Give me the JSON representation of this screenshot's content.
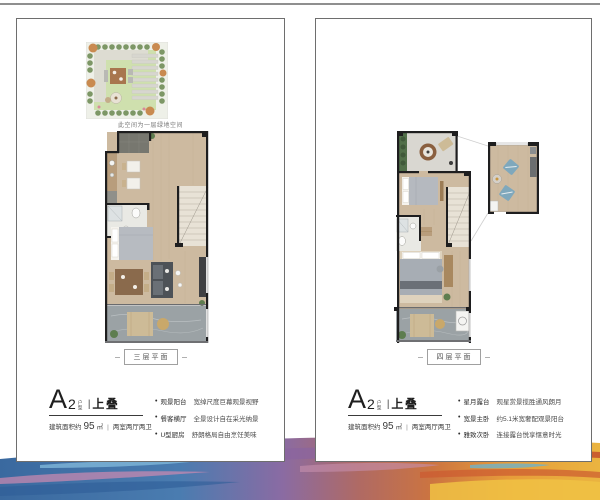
{
  "page": {
    "top_rule_color": "#8f8f8f",
    "background": "#ffffff"
  },
  "palette": {
    "wall": "#1e1e1f",
    "wood_floor": "#cdbaa0",
    "stone_floor": "#9ba2a5",
    "entry_tile": "#77776f",
    "accent_chair_blue": "#7fa8bc",
    "garden_lawn": "#cfe0ae",
    "paint_left_blue": "#3a699f",
    "paint_right_orange": "#e79d3a",
    "label_border": "#a0a0a0",
    "text_dark": "#1f1f1f",
    "text_gray": "#555555"
  },
  "panels": [
    {
      "garden_caption": "此空间为一层绿地空间",
      "floor_label": "三层平面",
      "unit": {
        "letter": "A",
        "number": "2",
        "small": "户型",
        "sep": "|",
        "name": "上叠"
      },
      "area": {
        "prefix": "建筑面积约",
        "value": "95",
        "unit": "㎡",
        "sep": "|",
        "rooms": "两室两厅两卫"
      },
      "bullets": [
        {
          "head": "观景阳台",
          "desc": "宽绰尺度巨幕观景视野"
        },
        {
          "head": "餐客横厅",
          "desc": "全景设计自在采光纳景"
        },
        {
          "head": "U型厨房",
          "desc": "舒朗格局自由烹饪美味"
        }
      ]
    },
    {
      "floor_label": "四层平面",
      "unit": {
        "letter": "A",
        "number": "2",
        "small": "户型",
        "sep": "|",
        "name": "上叠"
      },
      "area": {
        "prefix": "建筑面积约",
        "value": "95",
        "unit": "㎡",
        "sep": "|",
        "rooms": "两室两厅两卫"
      },
      "bullets": [
        {
          "head": "星月露台",
          "desc": "观星赏景揽胜通风朗月"
        },
        {
          "head": "宽景主卧",
          "desc": "约5.1米宽奢配观景阳台"
        },
        {
          "head": "雅致次卧",
          "desc": "连接露台悦享惬意时光"
        }
      ]
    }
  ]
}
